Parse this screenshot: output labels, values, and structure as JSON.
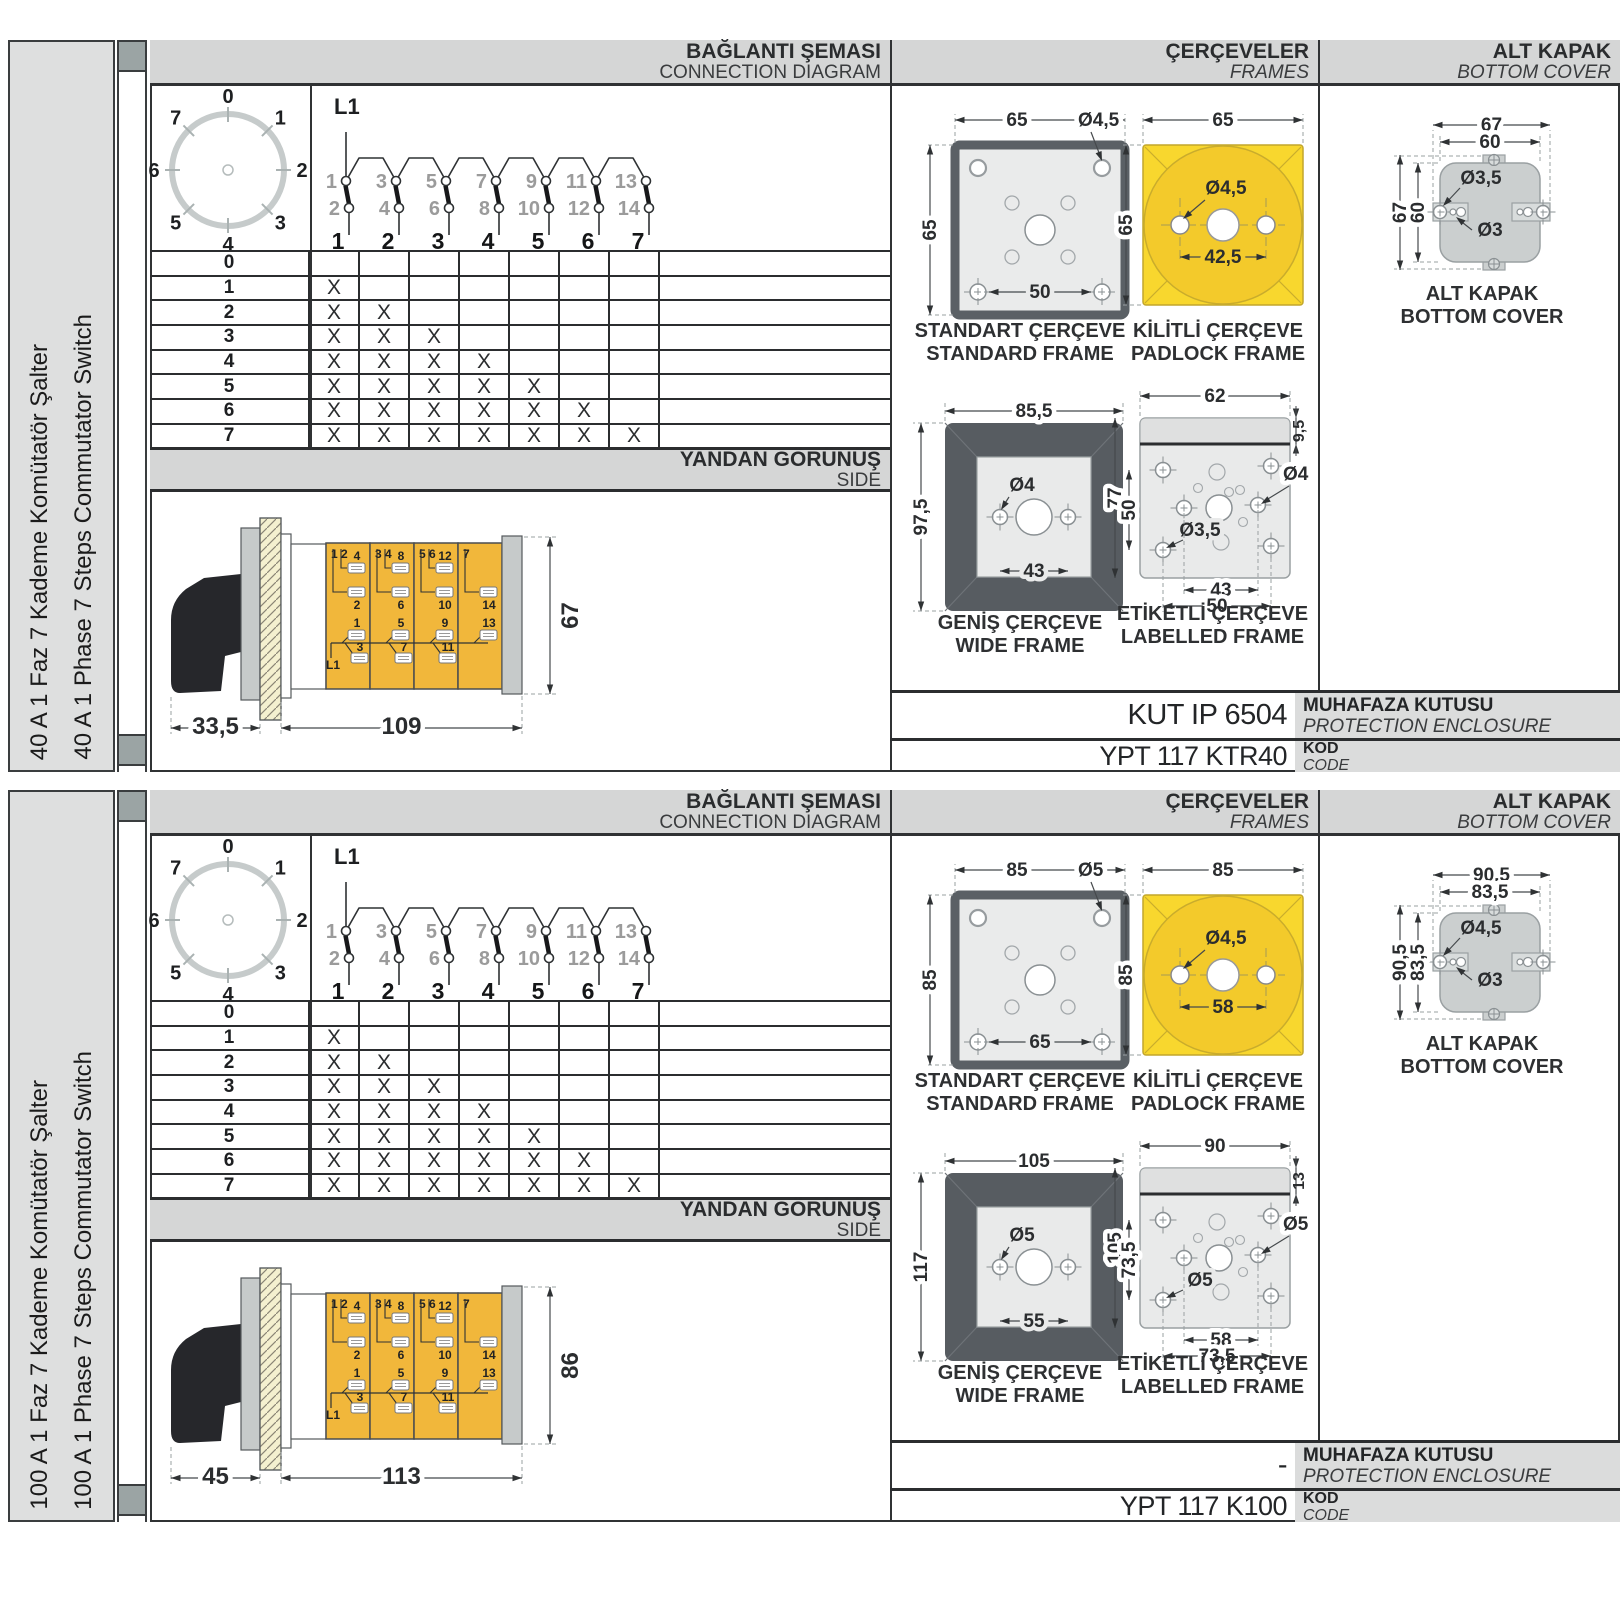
{
  "page": {
    "bg": "#ffffff"
  },
  "colors": {
    "header_bar": "#d5d6d6",
    "side_column": "#dedfdf",
    "padlock_yellow": "#f8d72e",
    "padlock_circle": "#f3ca2b",
    "module_yellow": "#f1b73b",
    "metal_gray": "#c7cbcb",
    "frame_dark": "#575c61",
    "line_dark": "#2f3234"
  },
  "panels": [
    {
      "side_labels": {
        "tr": "40 A 1 Faz 7 Kademe Komütatör Şalter",
        "en": "40 A 1 Phase 7 Steps Commutator Switch"
      },
      "headers": {
        "connection": {
          "tr": "BAĞLANTI ŞEMASI",
          "en": "CONNECTION DIAGRAM"
        },
        "frames": {
          "tr": "ÇERÇEVELER",
          "en": "FRAMES"
        },
        "cover": {
          "tr": "ALT KAPAK",
          "en": "BOTTOM COVER"
        }
      },
      "dial": {
        "positions": [
          "0",
          "1",
          "2",
          "3",
          "4",
          "5",
          "6",
          "7"
        ]
      },
      "contact_diagram": {
        "feed": "L1",
        "top": [
          "1",
          "3",
          "5",
          "7",
          "9",
          "11",
          "13"
        ],
        "bottom": [
          "2",
          "4",
          "6",
          "8",
          "10",
          "12",
          "14"
        ],
        "columns": [
          "1",
          "2",
          "3",
          "4",
          "5",
          "6",
          "7"
        ]
      },
      "step_table": {
        "mark": "X",
        "rows": [
          {
            "step": "0",
            "marks": [
              0,
              0,
              0,
              0,
              0,
              0,
              0
            ]
          },
          {
            "step": "1",
            "marks": [
              1,
              0,
              0,
              0,
              0,
              0,
              0
            ]
          },
          {
            "step": "2",
            "marks": [
              1,
              1,
              0,
              0,
              0,
              0,
              0
            ]
          },
          {
            "step": "3",
            "marks": [
              1,
              1,
              1,
              0,
              0,
              0,
              0
            ]
          },
          {
            "step": "4",
            "marks": [
              1,
              1,
              1,
              1,
              0,
              0,
              0
            ]
          },
          {
            "step": "5",
            "marks": [
              1,
              1,
              1,
              1,
              1,
              0,
              0
            ]
          },
          {
            "step": "6",
            "marks": [
              1,
              1,
              1,
              1,
              1,
              1,
              0
            ]
          },
          {
            "step": "7",
            "marks": [
              1,
              1,
              1,
              1,
              1,
              1,
              1
            ]
          }
        ]
      },
      "side_bar": {
        "tr": "YANDAN GÖRÜNÜŞ",
        "en": "SIDE"
      },
      "side_view": {
        "feed": "L1",
        "modules": [
          {
            "header": "1 2",
            "up_top": "4",
            "up_bot": "2",
            "low_top": "1",
            "low_bot": "3"
          },
          {
            "header": "3 4",
            "up_top": "8",
            "up_bot": "6",
            "low_top": "5",
            "low_bot": "7"
          },
          {
            "header": "5 6",
            "up_top": "12",
            "up_bot": "10",
            "low_top": "9",
            "low_bot": "11"
          },
          {
            "header": "7",
            "up_top": "",
            "up_bot": "14",
            "low_top": "13",
            "low_bot": ""
          }
        ],
        "dims": {
          "front": "33,5",
          "body": "109",
          "height": "67"
        }
      },
      "frames": {
        "standard": {
          "cap_tr": "STANDART ÇERÇEVE",
          "cap_en": "STANDARD FRAME",
          "top": "65",
          "left": "65",
          "inner": "50",
          "hole": "Ø4,5"
        },
        "padlock": {
          "cap_tr": "KİLİTLİ ÇERÇEVE",
          "cap_en": "PADLOCK FRAME",
          "top": "65",
          "left": "65",
          "inner": "42,5",
          "hole": "Ø4,5"
        },
        "wide": {
          "cap_tr": "GENİŞ ÇERÇEVE",
          "cap_en": "WIDE FRAME",
          "top": "85,5",
          "left": "97,5",
          "inner": "43",
          "hole": "Ø4"
        },
        "labelled": {
          "cap_tr": "ETİKETLİ ÇERÇEVE",
          "cap_en": "LABELLED FRAME",
          "top": "62",
          "strip": "9,5",
          "left": "77",
          "left_inner": "50",
          "hole_right": "Ø4",
          "hole_left": "Ø3,5",
          "bottom_inner": "43",
          "bottom_outer": "50"
        }
      },
      "cover": {
        "cap_tr": "ALT KAPAK",
        "cap_en": "BOTTOM COVER",
        "top_outer": "67",
        "top_inner": "60",
        "left_outer": "67",
        "left_inner": "60",
        "hole_big": "Ø3,5",
        "hole_small": "Ø3"
      },
      "codes": {
        "enclosure_value": "KUT IP 6504",
        "enclosure_tr": "MUHAFAZA KUTUSU",
        "enclosure_en": "PROTECTION ENCLOSURE",
        "code_value": "YPT 117 KTR40",
        "code_tr": "KOD",
        "code_en": "CODE"
      }
    },
    {
      "side_labels": {
        "tr": "100 A 1 Faz 7 Kademe Komütatör Şalter",
        "en": "100 A 1 Phase 7 Steps Commutator Switch"
      },
      "headers": {
        "connection": {
          "tr": "BAĞLANTI ŞEMASI",
          "en": "CONNECTION DIAGRAM"
        },
        "frames": {
          "tr": "ÇERÇEVELER",
          "en": "FRAMES"
        },
        "cover": {
          "tr": "ALT KAPAK",
          "en": "BOTTOM COVER"
        }
      },
      "dial": {
        "positions": [
          "0",
          "1",
          "2",
          "3",
          "4",
          "5",
          "6",
          "7"
        ]
      },
      "contact_diagram": {
        "feed": "L1",
        "top": [
          "1",
          "3",
          "5",
          "7",
          "9",
          "11",
          "13"
        ],
        "bottom": [
          "2",
          "4",
          "6",
          "8",
          "10",
          "12",
          "14"
        ],
        "columns": [
          "1",
          "2",
          "3",
          "4",
          "5",
          "6",
          "7"
        ]
      },
      "step_table": {
        "mark": "X",
        "rows": [
          {
            "step": "0",
            "marks": [
              0,
              0,
              0,
              0,
              0,
              0,
              0
            ]
          },
          {
            "step": "1",
            "marks": [
              1,
              0,
              0,
              0,
              0,
              0,
              0
            ]
          },
          {
            "step": "2",
            "marks": [
              1,
              1,
              0,
              0,
              0,
              0,
              0
            ]
          },
          {
            "step": "3",
            "marks": [
              1,
              1,
              1,
              0,
              0,
              0,
              0
            ]
          },
          {
            "step": "4",
            "marks": [
              1,
              1,
              1,
              1,
              0,
              0,
              0
            ]
          },
          {
            "step": "5",
            "marks": [
              1,
              1,
              1,
              1,
              1,
              0,
              0
            ]
          },
          {
            "step": "6",
            "marks": [
              1,
              1,
              1,
              1,
              1,
              1,
              0
            ]
          },
          {
            "step": "7",
            "marks": [
              1,
              1,
              1,
              1,
              1,
              1,
              1
            ]
          }
        ]
      },
      "side_bar": {
        "tr": "YANDAN GÖRÜNÜŞ",
        "en": "SIDE"
      },
      "side_view": {
        "feed": "L1",
        "modules": [
          {
            "header": "1 2",
            "up_top": "4",
            "up_bot": "2",
            "low_top": "1",
            "low_bot": "3"
          },
          {
            "header": "3 4",
            "up_top": "8",
            "up_bot": "6",
            "low_top": "5",
            "low_bot": "7"
          },
          {
            "header": "5 6",
            "up_top": "12",
            "up_bot": "10",
            "low_top": "9",
            "low_bot": "11"
          },
          {
            "header": "7",
            "up_top": "",
            "up_bot": "14",
            "low_top": "13",
            "low_bot": ""
          }
        ],
        "dims": {
          "front": "45",
          "body": "113",
          "height": "86"
        }
      },
      "frames": {
        "standard": {
          "cap_tr": "STANDART ÇERÇEVE",
          "cap_en": "STANDARD FRAME",
          "top": "85",
          "left": "85",
          "inner": "65",
          "hole": "Ø5"
        },
        "padlock": {
          "cap_tr": "KİLİTLİ ÇERÇEVE",
          "cap_en": "PADLOCK FRAME",
          "top": "85",
          "left": "85",
          "inner": "58",
          "hole": "Ø4,5"
        },
        "wide": {
          "cap_tr": "GENİŞ ÇERÇEVE",
          "cap_en": "WIDE FRAME",
          "top": "105",
          "left": "117",
          "inner": "55",
          "hole": "Ø5"
        },
        "labelled": {
          "cap_tr": "ETİKETLİ ÇERÇEVE",
          "cap_en": "LABELLED FRAME",
          "top": "90",
          "strip": "13",
          "left": "105",
          "left_inner": "73,5",
          "hole_right": "Ø5",
          "hole_left": "Ø5",
          "bottom_inner": "58",
          "bottom_outer": "73,5"
        }
      },
      "cover": {
        "cap_tr": "ALT KAPAK",
        "cap_en": "BOTTOM COVER",
        "top_outer": "90,5",
        "top_inner": "83,5",
        "left_outer": "90,5",
        "left_inner": "83,5",
        "hole_big": "Ø4,5",
        "hole_small": "Ø3"
      },
      "codes": {
        "enclosure_value": "-",
        "enclosure_tr": "MUHAFAZA KUTUSU",
        "enclosure_en": "PROTECTION ENCLOSURE",
        "code_value": "YPT 117 K100",
        "code_tr": "KOD",
        "code_en": "CODE"
      }
    }
  ]
}
